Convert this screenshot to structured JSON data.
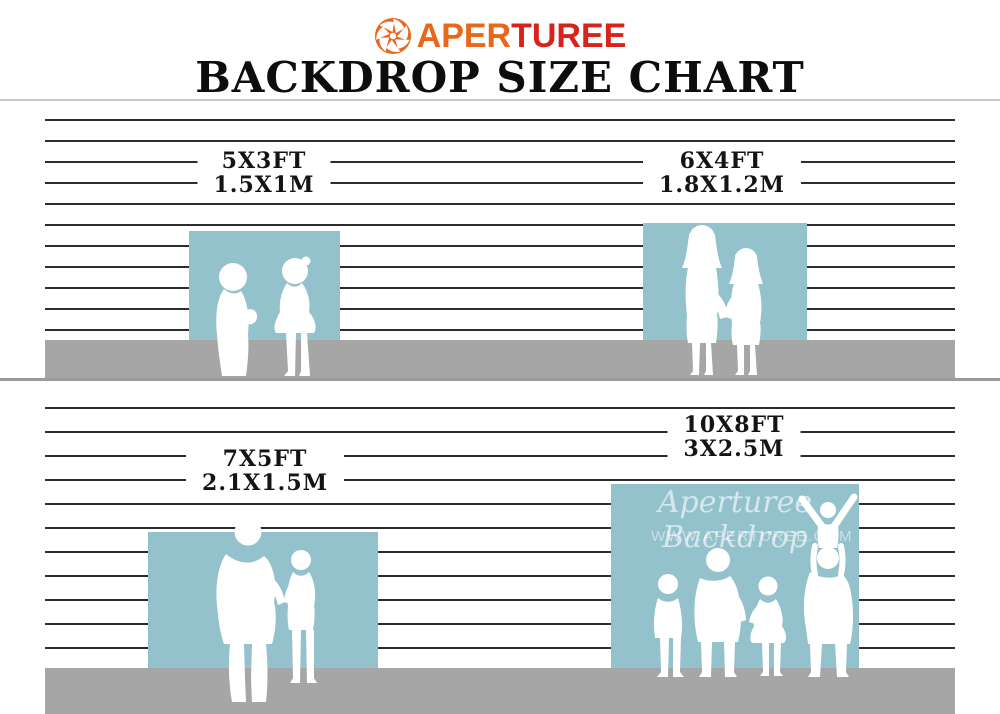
{
  "header": {
    "logo": {
      "prefix": "APER",
      "suffix": "TUREE"
    },
    "title": "BACKDROP SIZE CHART"
  },
  "labels": [
    {
      "ft": "5X3FT",
      "m": "1.5X1M"
    },
    {
      "ft": "6X4FT",
      "m": "1.8X1.2M"
    },
    {
      "ft": "7X5FT",
      "m": "2.1X1.5M"
    },
    {
      "ft": "10X8FT",
      "m": "3X2.5M"
    }
  ],
  "watermark": {
    "script": "Aperturee Backdrop",
    "url": "WWW.APERTUREE.COM"
  },
  "icons": {
    "logo": "aperture-icon"
  },
  "colors": {
    "logo_orange": "#e8671b",
    "logo_red": "#d8231c",
    "backdrop_blue": "#93c1cc",
    "floor_gray": "#a6a6a6",
    "stripe_dark": "#2c2c2c",
    "title_black": "#0d0d0d"
  }
}
